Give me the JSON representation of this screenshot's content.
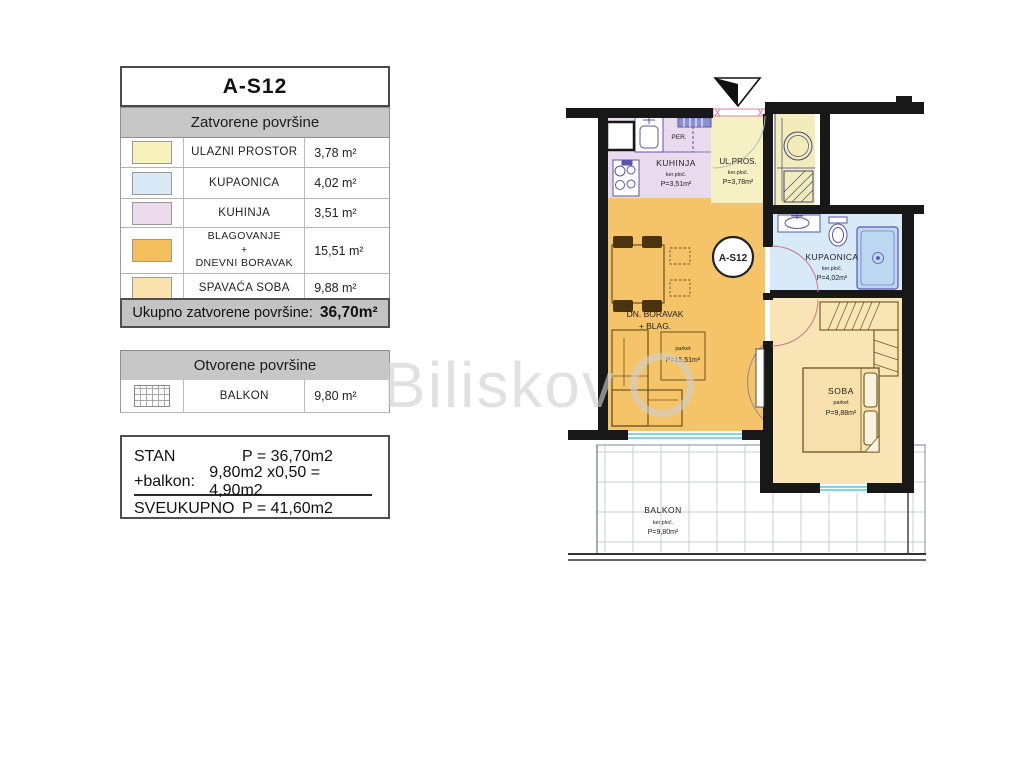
{
  "watermark": "Biliskov",
  "legend": {
    "title": "A-S12",
    "closed_header": "Zatvorene površine",
    "closed_rows": [
      {
        "name": "ULAZNI PROSTOR",
        "area": "3,78 m²",
        "color": "#F7F2BC"
      },
      {
        "name": "KUPAONICA",
        "area": "4,02 m²",
        "color": "#D9E9F6"
      },
      {
        "name": "KUHINJA",
        "area": "3,51 m²",
        "color": "#EBDAEC"
      },
      {
        "name_line1": "BLAGOVANJE",
        "name_line2": "+",
        "name_line3": "DNEVNI BORAVAK",
        "area": "15,51 m²",
        "color": "#F5BE5C"
      },
      {
        "name": "SPAVAĆA SOBA",
        "area": "9,88 m²",
        "color": "#FAE3AC"
      }
    ],
    "closed_total_label": "Ukupno zatvorene površine:",
    "closed_total_value": "36,70m²",
    "open_header": "Otvorene površine",
    "open_row": {
      "name": "BALKON",
      "area": "9,80 m²"
    },
    "summary": {
      "stan_label": "STAN",
      "stan_value": "P = 36,70m2",
      "balkon_label": "+balkon:",
      "balkon_value": "9,80m2 x0,50 =  4,90m2",
      "total_label": "SVEUKUPNO",
      "total_value": "P = 41,60m2"
    }
  },
  "plan": {
    "unit_badge": "A-S12",
    "appliance_label": "PER.",
    "rooms": {
      "kuhinja": {
        "name": "KUHINJA",
        "floor": "ker.ploč.",
        "area": "P=3,51m²"
      },
      "ulpros": {
        "name": "UL.PROS.",
        "floor": "ker.ploč.",
        "area": "P=3,78m²"
      },
      "kupaonica": {
        "name": "KUPAONICA",
        "floor": "ker.ploč.",
        "area": "P=4,02m²"
      },
      "boravak": {
        "name_line1": "DN. BORAVAK",
        "name_line2": "+ BLAG.",
        "floor": "parket",
        "area": "P=15,51m²"
      },
      "soba": {
        "name": "SOBA",
        "floor": "parket",
        "area": "P=9,88m²"
      },
      "balkon": {
        "name": "BALKON",
        "floor": "ker.ploč.",
        "area": "P=9,80m²"
      }
    }
  }
}
